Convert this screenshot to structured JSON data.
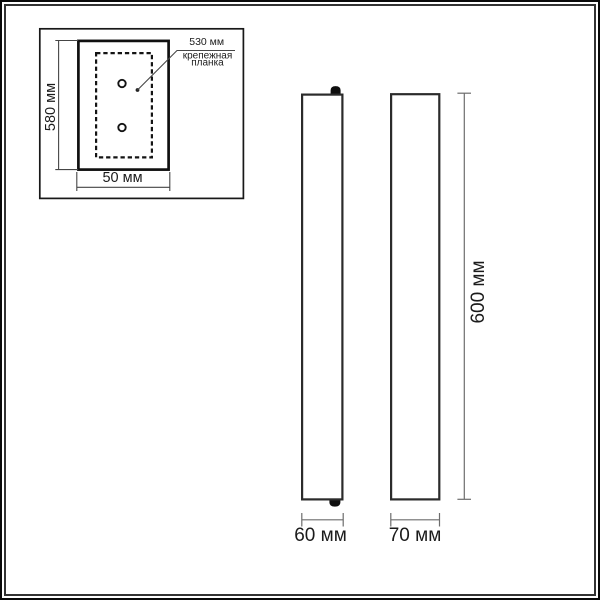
{
  "drawing": {
    "kind": "wall-light dimensional drawing",
    "units": "мм",
    "back_view": {
      "height": "580 мм",
      "width": "50 мм",
      "plate_length": "530 мм",
      "plate_label_line1": "крепежная",
      "plate_label_line2": "планка",
      "screw_holes": 2
    },
    "side_view": {
      "width": "60 мм"
    },
    "front_view": {
      "width": "70 мм",
      "height": "600 мм"
    },
    "colors": {
      "background": "#ffffff",
      "outline": "#2b2b2b",
      "dimension_line": "#6d6d6d",
      "text": "#1b1b1b",
      "frame_outer": "#0a0a0a",
      "frame_inner": "#333333"
    }
  }
}
